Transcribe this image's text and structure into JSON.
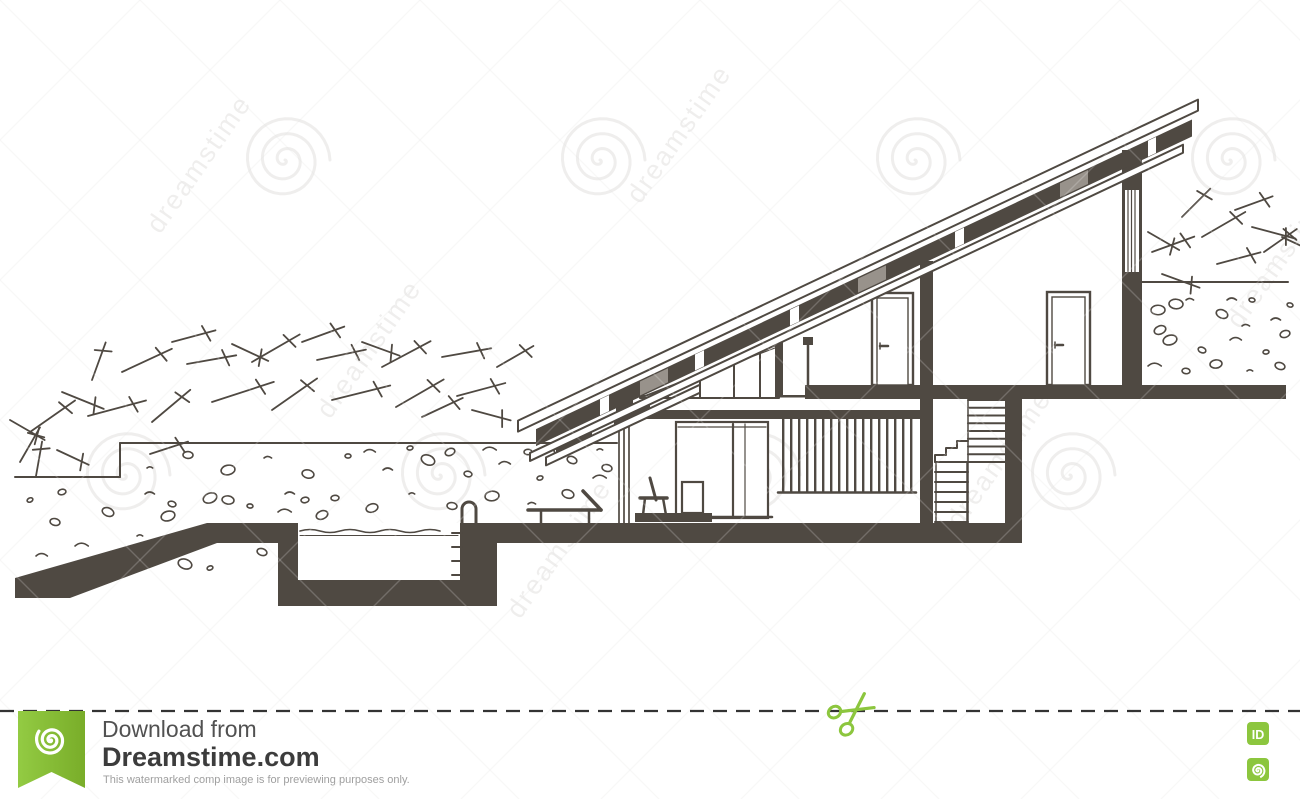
{
  "image": {
    "width": 1300,
    "height": 799
  },
  "drawing": {
    "subject": "Architectural sketch: cross-section of a modern single-pitch-roof house with swimming pool",
    "elements": [
      "mono-pitch sloped roof",
      "clerestory glazing",
      "interior doors",
      "mezzanine railing",
      "two-flight staircase",
      "swimming pool with ladder",
      "sun lounger",
      "floor lamp",
      "chair",
      "terrain with rocks and shrubs"
    ],
    "colors": {
      "ink": "#4f4942",
      "halftone_gray": "#98928b",
      "paper": "#ffffff"
    }
  },
  "watermark": {
    "brand_text": "dreamstime",
    "color": "#6b645c"
  },
  "footer": {
    "download_label": "Download from",
    "site_name": "Dreamstime.com",
    "disclaimer": "This watermarked comp image is for previewing purposes only.",
    "id_badge_label": "ID",
    "green": "#8cc63e",
    "icons": [
      "scissors-icon",
      "dreamstime-ribbon-logo",
      "id-badge",
      "copyright-spiral-icon"
    ]
  }
}
